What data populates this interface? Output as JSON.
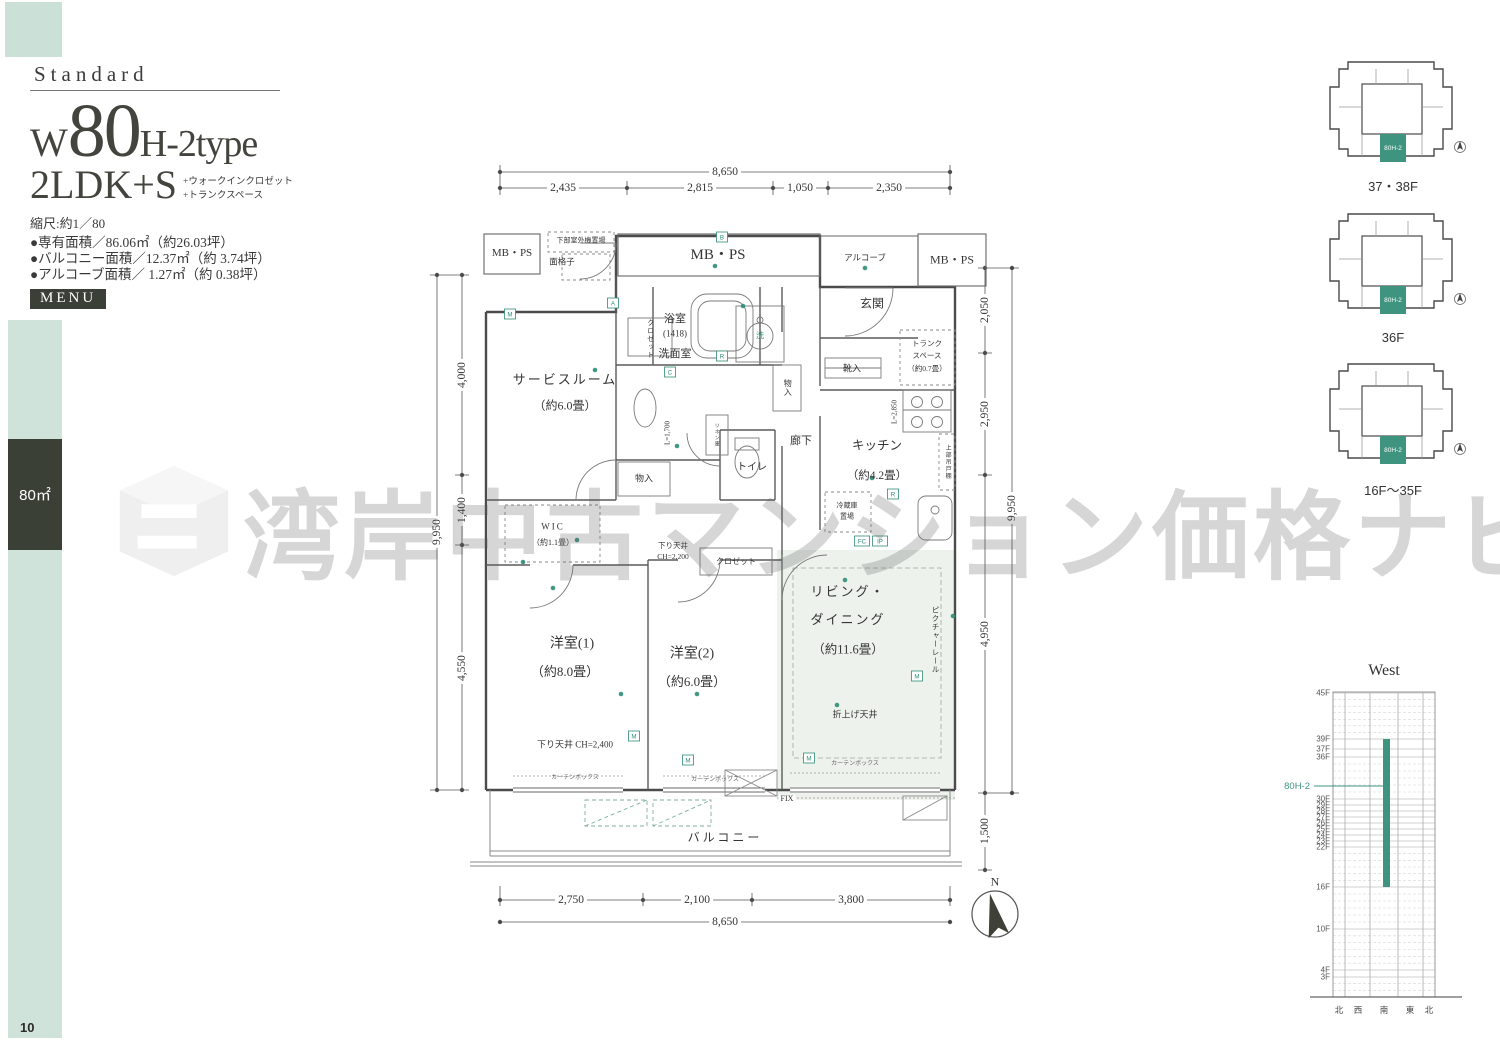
{
  "page": {
    "number": "10"
  },
  "accent": "#3f9480",
  "sidebar": {
    "area_label": "80㎡"
  },
  "header": {
    "standard": "Standard",
    "type_w": "W",
    "type_num": "80",
    "type_suffix": "H-2type",
    "layout": "2LDK+S",
    "layout_note1": "+ウォークインクロゼット",
    "layout_note2": "+トランクスペース",
    "scale": "縮尺:約1／80",
    "areas": [
      "●専有面積／86.06㎡（約26.03坪）",
      "●バルコニー面積／12.37㎡（約 3.74坪）",
      "●アルコーブ面積／ 1.27㎡（約 0.38坪）"
    ],
    "menu": "MENU"
  },
  "watermark": {
    "text": "湾岸中古マンション価格ナビ"
  },
  "plan": {
    "rooms": {
      "mbps_left": "MB・PS",
      "mbps_center": "MB・PS",
      "mbps_right": "MB・PS",
      "outdoor_unit": "下部室外機置場",
      "lattice": "面格子",
      "alcove": "アルコーブ",
      "entrance": "玄関",
      "bath": "浴室",
      "bath_size": "(1418)",
      "closet_top": "クロゼット",
      "washroom": "洗面室",
      "wash": "洗",
      "monoire_hall": "物入",
      "monoire_left": "物入",
      "linen": "リネン庫",
      "l1700": "L=1,700",
      "toilet": "トイレ",
      "corridor": "廊下",
      "shoes": "靴入",
      "trunk1": "トランク",
      "trunk2": "スペース",
      "trunk3": "（約0.7畳）",
      "kitchen": "キッチン",
      "kitchen_size": "（約4.2畳）",
      "l2850": "L=2,850",
      "hanging": "上部吊戸棚",
      "fridge1": "冷蔵庫",
      "fridge2": "置場",
      "service": "サービスルーム",
      "service_size": "（約6.0畳）",
      "wic": "WIC",
      "wic_size": "（約1.1畳）",
      "west1": "洋室(1)",
      "west1_size": "（約8.0畳）",
      "west2": "洋室(2)",
      "west2_size": "（約6.0畳）",
      "living1": "リビング・",
      "living2": "ダイニング",
      "living_size": "（約11.6畳）",
      "picture_rail": "ピクチャーレール",
      "coffered": "折上げ天井",
      "down1": "下り天井 CH=2,400",
      "down2a": "下り天井",
      "down2b": "CH=2,200",
      "closet2": "クロゼット",
      "curtain": "カーテンボックス",
      "fix": "FIX",
      "balcony": "バルコニー",
      "north": "N"
    },
    "dims": {
      "top_total": "8,650",
      "top": [
        "2,435",
        "2,815",
        "1,050",
        "2,350"
      ],
      "left_total": "9,950",
      "left": [
        "4,000",
        "1,400",
        "4,550"
      ],
      "right_total": "9,950",
      "right": [
        "2,050",
        "2,950",
        "4,950",
        "1,500"
      ],
      "bottom_total": "8,650",
      "bottom": [
        "2,750",
        "2,100",
        "3,800"
      ]
    },
    "badges": [
      {
        "t": "B",
        "x": 297,
        "y": 89
      },
      {
        "t": "M",
        "x": 85,
        "y": 166
      },
      {
        "t": "A",
        "x": 188,
        "y": 155
      },
      {
        "t": "C",
        "x": 245,
        "y": 224
      },
      {
        "t": "R",
        "x": 297,
        "y": 208
      },
      {
        "t": "FC",
        "x": 437,
        "y": 393
      },
      {
        "t": "IP",
        "x": 455,
        "y": 393
      },
      {
        "t": "R",
        "x": 468,
        "y": 346
      },
      {
        "t": "M",
        "x": 209,
        "y": 588
      },
      {
        "t": "M",
        "x": 263,
        "y": 612
      },
      {
        "t": "M",
        "x": 384,
        "y": 610
      },
      {
        "t": "M",
        "x": 492,
        "y": 528
      }
    ],
    "dots": [
      [
        170,
        222
      ],
      [
        318,
        158
      ],
      [
        252,
        298
      ],
      [
        128,
        440
      ],
      [
        196,
        546
      ],
      [
        272,
        546
      ],
      [
        420,
        432
      ],
      [
        412,
        557
      ],
      [
        447,
        330
      ],
      [
        98,
        414
      ],
      [
        290,
        118
      ],
      [
        440,
        120
      ],
      [
        528,
        468
      ],
      [
        152,
        392
      ]
    ]
  },
  "floorplates": [
    {
      "label": "37・38F",
      "unit": "80H-2"
    },
    {
      "label": "36F",
      "unit": "80H-2"
    },
    {
      "label": "16F〜35F",
      "unit": "80H-2"
    }
  ],
  "elevation": {
    "title": "West",
    "unit_label": "80H-2",
    "unit_y": 131,
    "bar": {
      "top": "39F",
      "bottom": "16F"
    },
    "floors": [
      {
        "label": "45F",
        "y": 38
      },
      {
        "label": "39F",
        "y": 84
      },
      {
        "label": "37F",
        "y": 94
      },
      {
        "label": "36F",
        "y": 102
      },
      {
        "label": "30F",
        "y": 144
      },
      {
        "label": "29F",
        "y": 150
      },
      {
        "label": "28F",
        "y": 156
      },
      {
        "label": "27F",
        "y": 162
      },
      {
        "label": "26F",
        "y": 168
      },
      {
        "label": "25F",
        "y": 174
      },
      {
        "label": "24F",
        "y": 180
      },
      {
        "label": "23F",
        "y": 186
      },
      {
        "label": "22F",
        "y": 192
      },
      {
        "label": "16F",
        "y": 232
      },
      {
        "label": "10F",
        "y": 274
      },
      {
        "label": "4F",
        "y": 315
      },
      {
        "label": "3F",
        "y": 322
      }
    ],
    "directions": [
      "北",
      "西",
      "南",
      "東",
      "北"
    ]
  }
}
